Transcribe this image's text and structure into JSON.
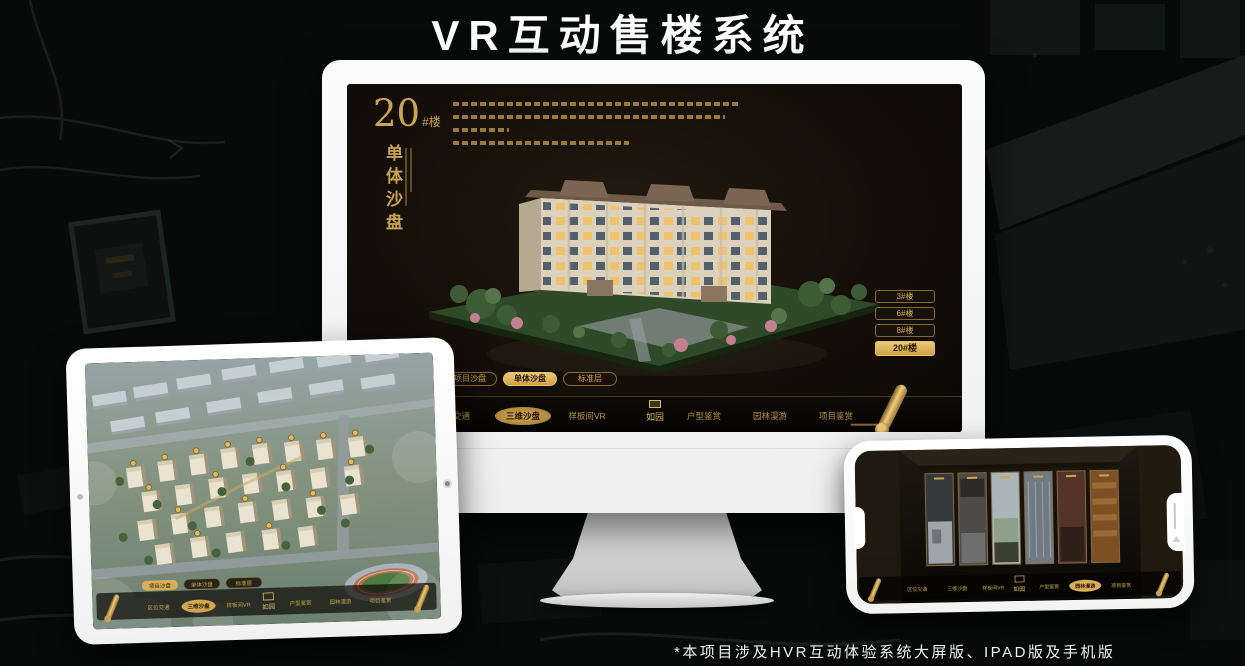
{
  "page": {
    "title": "VR互动售楼系统",
    "footnote": "*本项目涉及HVR互动体验系统大屏版、IPAD版及手机版"
  },
  "colors": {
    "gold": "#d4ab59",
    "gold_deep": "#8a6a30",
    "screen_bg": "#17110a",
    "monitor_white": "#f6f6f6"
  },
  "nav": {
    "logo": "如园",
    "items": [
      {
        "label": "区位交通"
      },
      {
        "label": "三维沙盘"
      },
      {
        "label": "样板间VR"
      },
      {
        "label": "户型鉴赏"
      },
      {
        "label": "园林漫游"
      },
      {
        "label": "项目鉴赏"
      }
    ],
    "sub_tabs": [
      {
        "label": "项目沙盘"
      },
      {
        "label": "单体沙盘"
      },
      {
        "label": "标准层"
      }
    ]
  },
  "monitor": {
    "block_number": "20",
    "block_number_suffix": "#楼",
    "block_subtitle": "单体沙盘",
    "active_nav": "三维沙盘",
    "active_sub_tab": "单体沙盘",
    "floor_buttons": [
      {
        "label": "3#楼",
        "active": false
      },
      {
        "label": "6#楼",
        "active": false
      },
      {
        "label": "8#楼",
        "active": false
      },
      {
        "label": "20#楼",
        "active": true
      }
    ]
  },
  "tablet": {
    "active_nav": "三维沙盘",
    "active_sub_tab": "项目沙盘"
  },
  "phone": {
    "active_nav": "园林漫游"
  }
}
